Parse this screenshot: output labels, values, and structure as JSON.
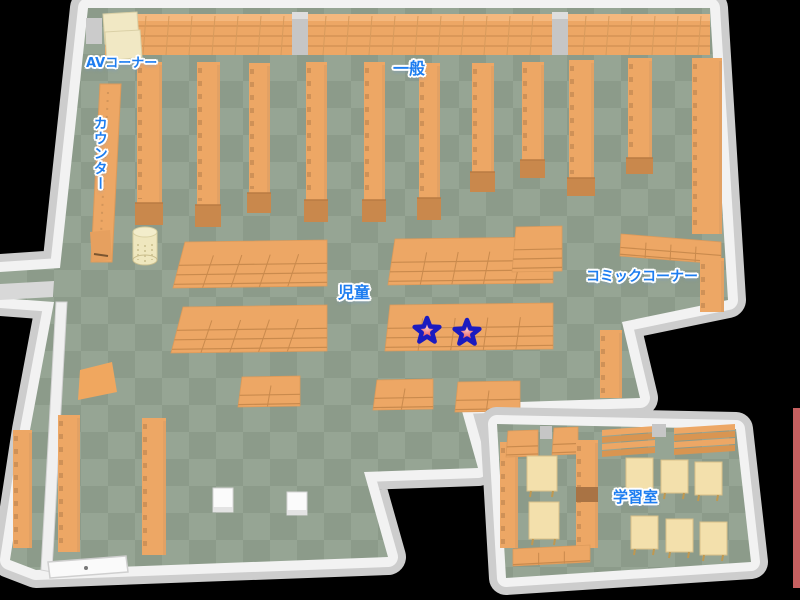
{
  "map": {
    "title": "library-floor-map",
    "areas": {
      "av_corner": "AVコーナー",
      "counter": "カウンター",
      "general": "一般",
      "children": "児童",
      "comic_corner": "コミックコーナー",
      "study_room": "学習室"
    },
    "markers": {
      "stars": [
        {
          "x": 427,
          "y": 331
        },
        {
          "x": 467,
          "y": 333
        }
      ]
    },
    "colors": {
      "floor_dark": "#8C9B8A",
      "floor_light": "#96A594",
      "shelf_orange": "#EDA765",
      "shelf_line": "#C98A4D",
      "shelf_foot": "#C9884C",
      "desk_cream": "#F3E0AC",
      "av_desk_cream": "#F1E8C4",
      "wall_white": "#F2F2F2",
      "wall_gray": "#CDCDCD",
      "label_blue": "#1D7DF0",
      "star_outline": "#1B1BC0",
      "star_red": "#E02828",
      "right_edge_red": "#C55F5F"
    }
  }
}
